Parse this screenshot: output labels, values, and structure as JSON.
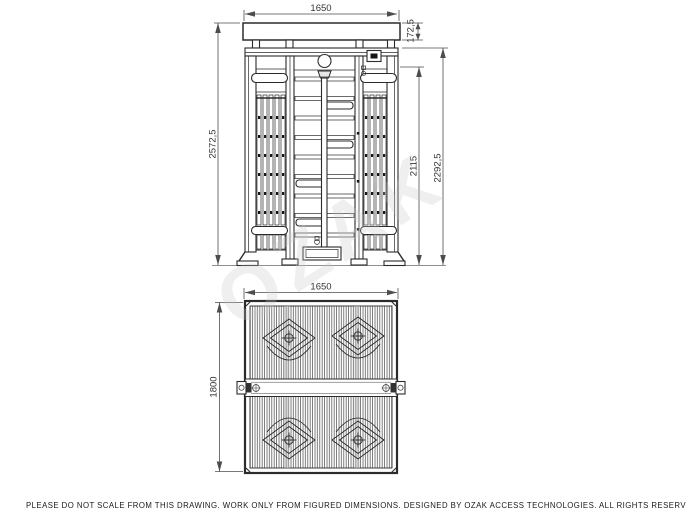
{
  "footer_note": "PLEASE DO NOT SCALE FROM THIS DRAWING. WORK ONLY FROM FIGURED DIMENSIONS.  DESIGNED BY OZAK ACCESS TECHNOLOGIES. ALL RIGHTS RESERVED.",
  "watermark_text": "OZAK",
  "dims": {
    "front_width": "1650",
    "canopy_height": "172,5",
    "total_height": "2572,5",
    "passage_height": "2115",
    "frame_height": "2292,5",
    "plan_width": "1650",
    "plan_depth": "1800"
  },
  "colors": {
    "line": "#2b2b2b",
    "dim_line": "#4d4d4d",
    "ground": "#8f8f8f",
    "watermark": "#c9c9c9"
  }
}
